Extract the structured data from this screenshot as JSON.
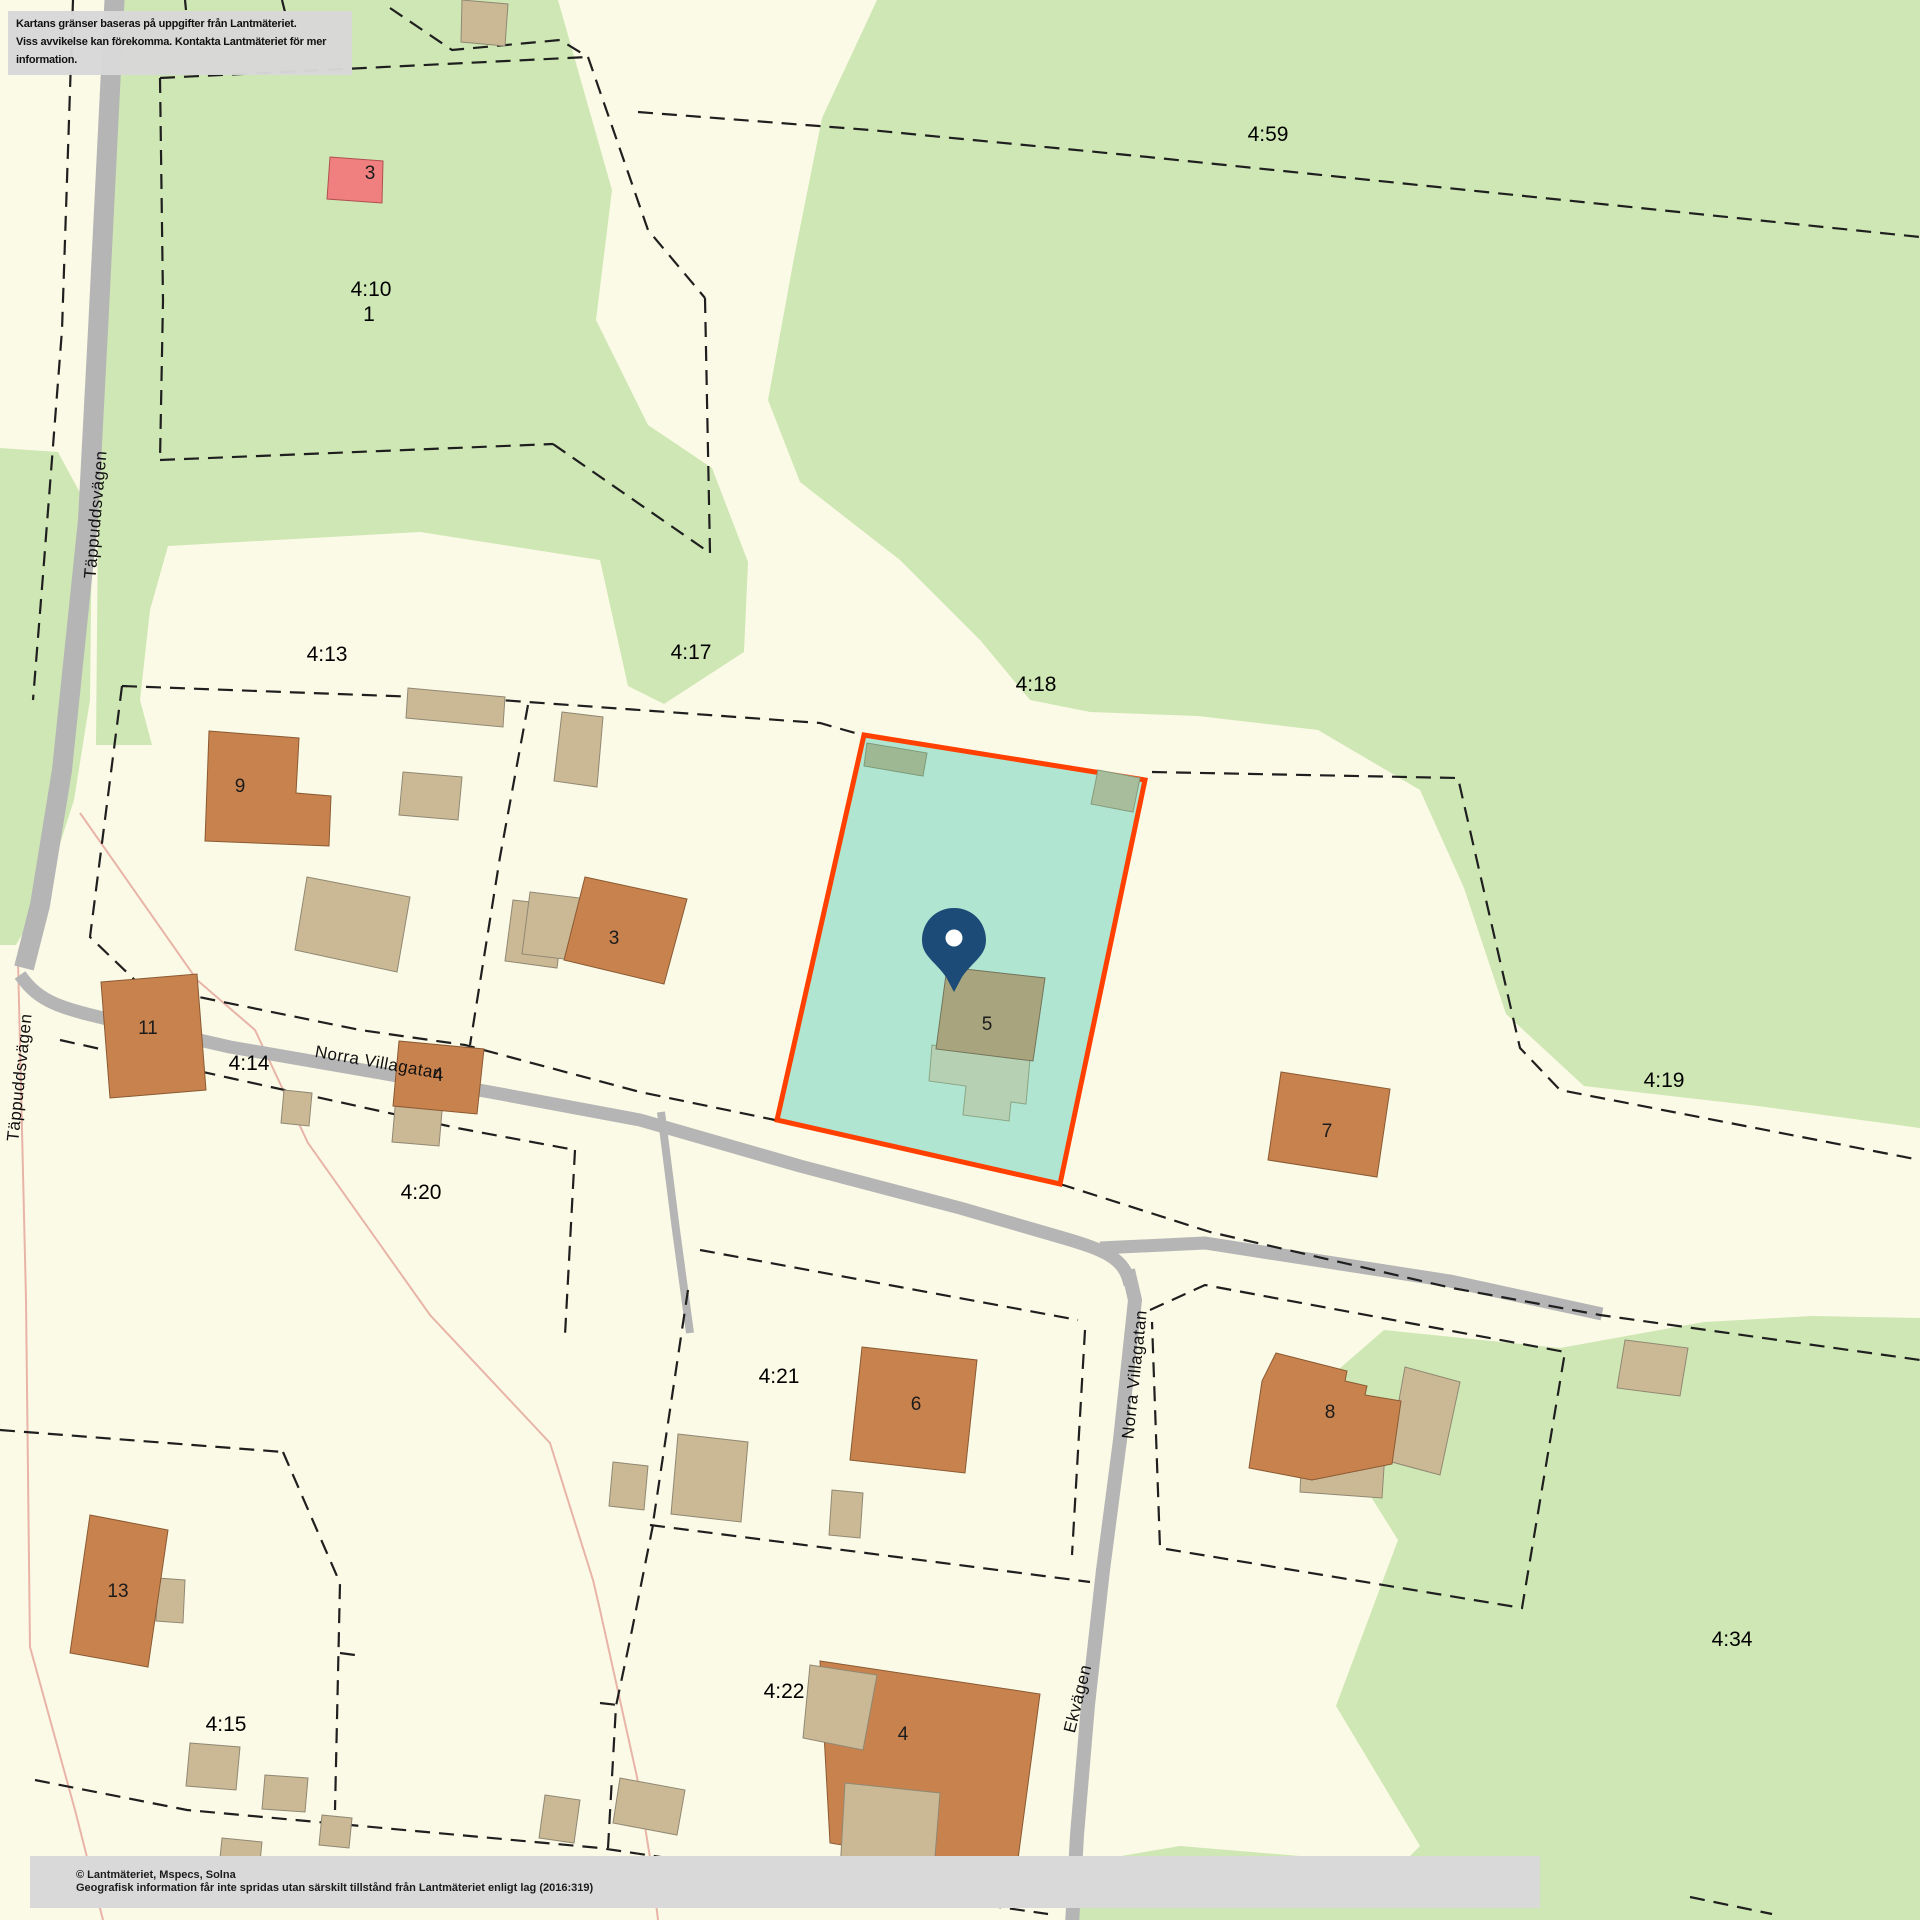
{
  "disclaimer": {
    "line1": "Kartans gränser baseras på uppgifter från Lantmäteriet.",
    "line2": "Viss avvikelse kan förekomma. Kontakta Lantmäteriet för mer information."
  },
  "copyright": {
    "line1": "© Lantmäteriet, Mspecs, Solna",
    "line2": "Geografisk information får inte spridas utan särskilt tillstånd från Lantmäteriet enligt lag (2016:319)"
  },
  "map": {
    "colors": {
      "background_cream": "#FBFAE6",
      "vegetation_green": "#CFE7B4",
      "road_gray": "#B5B5B5",
      "boundary_dash": "#1F1F1F",
      "highlight_parcel_fill": "#B0E5D1",
      "highlight_parcel_border": "#FF4000",
      "house_fill": "#C8824E",
      "outbuilding_fill": "#CBB995",
      "special_building_fill": "#F08080",
      "main_building_fill": "#A8A57E",
      "pin_color": "#1C4B77",
      "footpath_pink": "#E9B4A8"
    },
    "parcel_labels": [
      "4:59",
      "4:10",
      "1",
      "4:13",
      "4:17",
      "4:18",
      "4:19",
      "4:14",
      "4:20",
      "4:21",
      "4:22",
      "4:15",
      "4:34"
    ],
    "building_labels": [
      "3",
      "9",
      "3",
      "5",
      "7",
      "11",
      "4",
      "6",
      "8",
      "13",
      "4"
    ],
    "road_labels": [
      "Täppuddsvägen",
      "Täppuddsvägen",
      "Norra Villagatan",
      "Norra Villagatan",
      "Ekvägen"
    ]
  }
}
